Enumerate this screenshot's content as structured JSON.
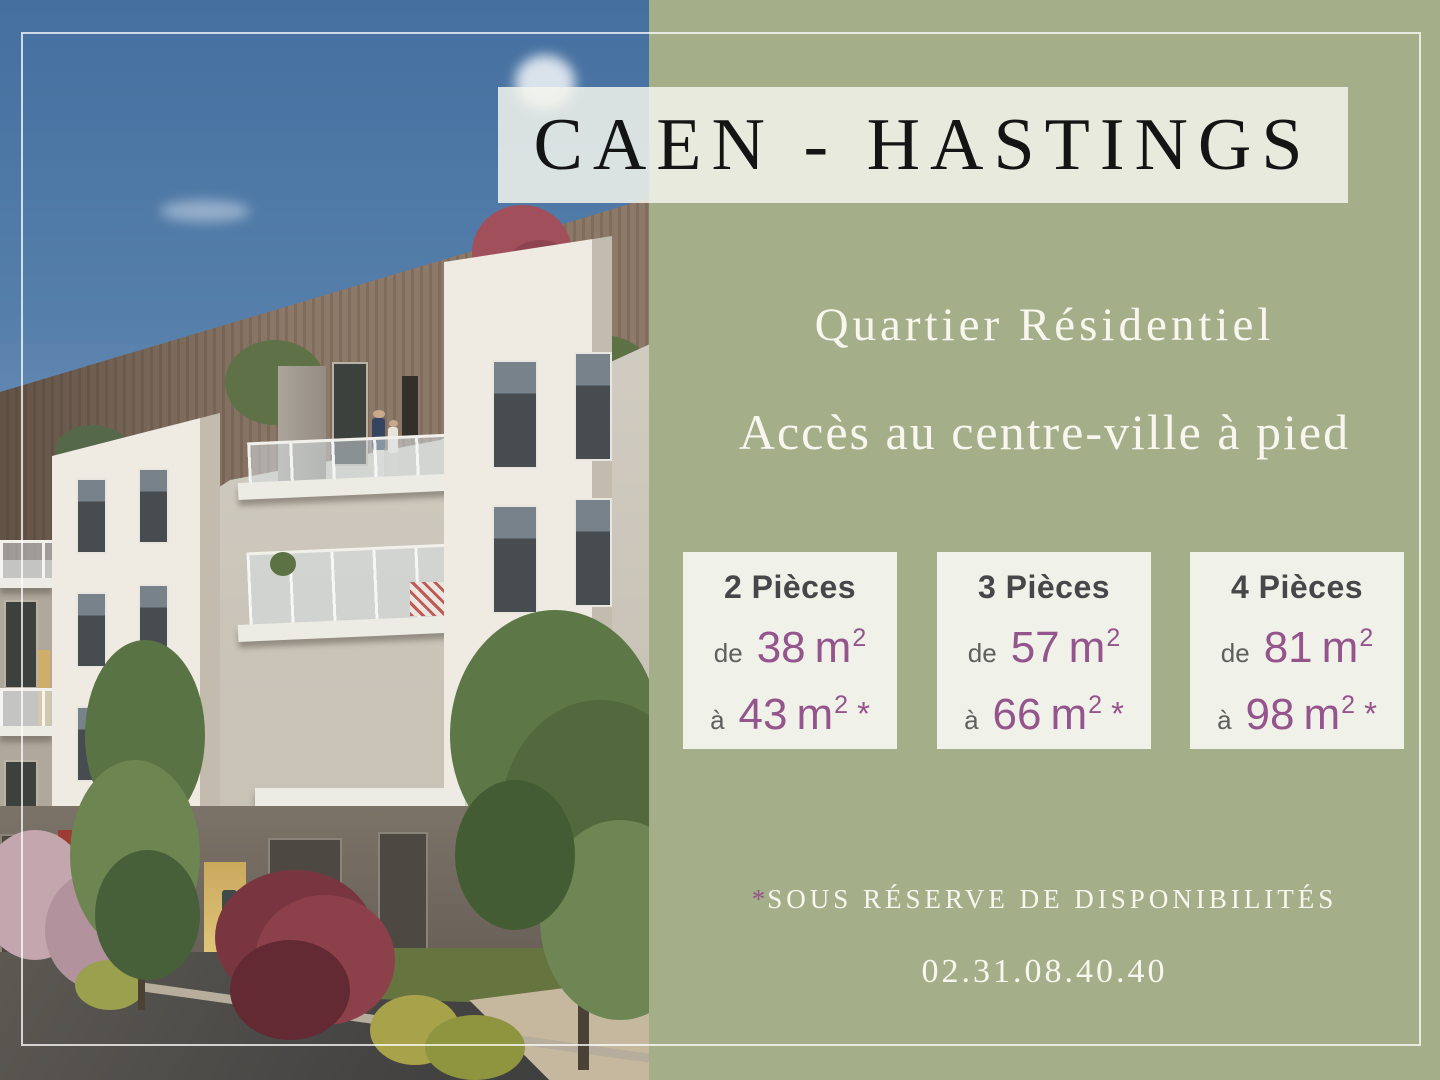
{
  "title": "CAEN - HASTINGS",
  "subtitles": {
    "line1": "Quartier Résidentiel",
    "line2": "Accès au centre-ville à pied"
  },
  "cards": [
    {
      "label": "2 Pièces",
      "from": {
        "prefix": "de",
        "value": "38",
        "unit": "m",
        "sup": "2"
      },
      "to": {
        "prefix": "à",
        "value": "43",
        "unit": "m",
        "sup": "2",
        "star": "*"
      }
    },
    {
      "label": "3 Pièces",
      "from": {
        "prefix": "de",
        "value": "57",
        "unit": "m",
        "sup": "2"
      },
      "to": {
        "prefix": "à",
        "value": "66",
        "unit": "m",
        "sup": "2",
        "star": "*"
      }
    },
    {
      "label": "4 Pièces",
      "from": {
        "prefix": "de",
        "value": "81",
        "unit": "m",
        "sup": "2"
      },
      "to": {
        "prefix": "à",
        "value": "98",
        "unit": "m",
        "sup": "2",
        "star": "*"
      }
    }
  ],
  "footnote": {
    "asterisk": "*",
    "text": "SOUS RÉSERVE DE DISPONIBILITÉS"
  },
  "phone": "02.31.08.40.40",
  "colors": {
    "green-panel": "#a4af89",
    "card-bg": "#f0f1e9",
    "overlay-bg": "#f3f4ec",
    "accent-purple": "#94548c",
    "heading-dark": "#474749",
    "muted-gray": "#5f5f5d",
    "title-black": "#141414",
    "light-text": "#f8f7ef"
  }
}
